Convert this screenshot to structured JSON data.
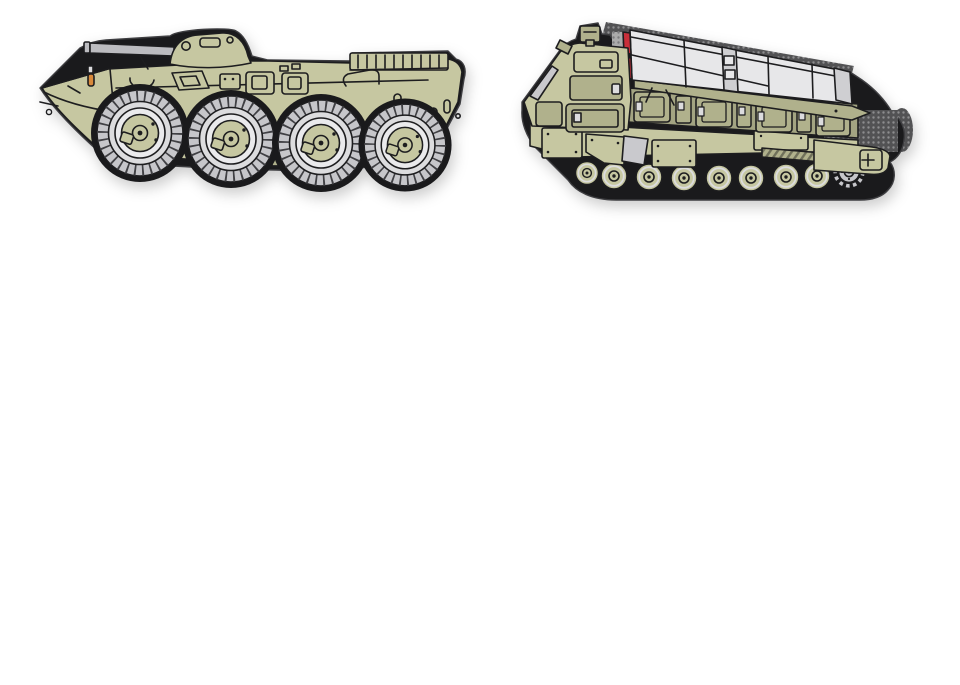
{
  "scene": {
    "description": "Two olive-green military vehicle PVC rubber morale patches photographed on a plain white background"
  },
  "patches": [
    {
      "id": "apc-patch",
      "label": "Eight-wheeled armored personnel carrier PVC patch: olive BTR-style hull, small turret with gun barrel, four large grey road wheels, black rubber border",
      "visible_wheels": 4
    },
    {
      "id": "launcher-patch",
      "label": "Tracked missile launcher PVC patch: olive cab and hull, grey missile canister with red tips, eight road wheels with rear drive sprocket, grey hook-velcro backing peeking out",
      "road_wheels": 8,
      "missile_tips": 2
    }
  ],
  "theme": {
    "bg": "#ffffff",
    "patch-border": "#1a1a1c",
    "border-sheen": "#3d3d40",
    "outline": "#1d1d1f",
    "body": "#c6c7a1",
    "body-dark": "#b0b18c",
    "body-darker": "#a3a482",
    "tire": "#c6c6ca",
    "tire-tick": "#404044",
    "rim": "#dcdcde",
    "rim-inner": "#eaeaec",
    "canister": "#e7e7e9",
    "canister-shade": "#cfcfd2",
    "red-tip": "#c92f3a",
    "steel": "#bcbcc0",
    "glass": "#c9c9cc",
    "track-stripe": "#c9c9cd",
    "amber": "#d8893b",
    "velcro": "#ababab",
    "velcro-dot": "#7c7c7e",
    "velcro-dark": "#525254",
    "velcro-dark-dot": "#8d8d8f"
  }
}
